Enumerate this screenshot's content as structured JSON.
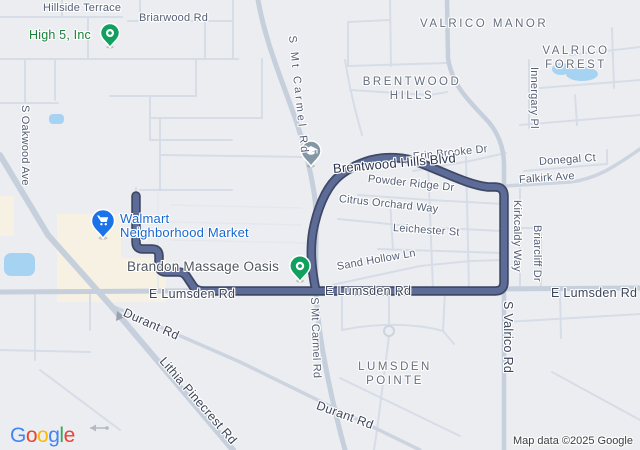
{
  "map": {
    "attribution": "Map data ©2025 Google",
    "google_logo_letters": [
      [
        "G",
        "#4285F4"
      ],
      [
        "o",
        "#EA4335"
      ],
      [
        "o",
        "#FBBC05"
      ],
      [
        "g",
        "#4285F4"
      ],
      [
        "l",
        "#34A853"
      ],
      [
        "e",
        "#EA4335"
      ]
    ],
    "route_color": "#5d6b97",
    "route_casing_color": "#3f4865",
    "water_color": "#a7d3f2",
    "commercial_area_color": "#f6f1e2"
  },
  "districts": {
    "valrico_manor": "VALRICO MANOR",
    "valrico_forest": "VALRICO FOREST",
    "brentwood_hills": "BRENTWOOD\nHILLS",
    "lumsden_pointe": "LUMSDEN\nPOINTE"
  },
  "streets": {
    "hillside_terrace": "Hillside Terrace",
    "briarwood_rd": "Briarwood Rd",
    "s_oakwood_ave": "S Oakwood Ave",
    "s_mt_carmel_rd": "S Mt Carmel Rd",
    "brentwood_hills_blvd": "Brentwood Hills Blvd",
    "erin_brooke_dr": "Erin Brooke Dr",
    "powder_ridge_dr": "Powder Ridge Dr",
    "citrus_orchard_way": "Citrus Orchard Way",
    "leichester_st": "Leichester St",
    "sand_hollow_ln": "Sand Hollow Ln",
    "donegal_ct": "Donegal Ct",
    "falkirk_ave": "Falkirk Ave",
    "innergary_pl": "Innergary Pl",
    "kirkcaldy_way": "Kirkcaldy Way",
    "briarcliff_dr": "Briarcliff Dr",
    "s_valrico_rd": "S Valrico Rd",
    "e_lumsden_rd": "E Lumsden Rd",
    "durant_rd": "Durant Rd",
    "lithia_pinecrest_rd": "Lithia Pinecrest Rd"
  },
  "pois": {
    "high_5_inc": {
      "name": "High 5, Inc",
      "text_color": "#188038",
      "pin_color": "#12a05f"
    },
    "walmart": {
      "line1": "Walmart",
      "line2": "Neighborhood Market",
      "text_color": "#1967d2",
      "pin_color": "#1a73e8"
    },
    "brandon_massage_oasis": {
      "name": "Brandon Massage Oasis",
      "text_color": "#50565f",
      "pin_color": "#12a05f"
    },
    "school": {
      "pin_color": "#8596a5"
    }
  }
}
